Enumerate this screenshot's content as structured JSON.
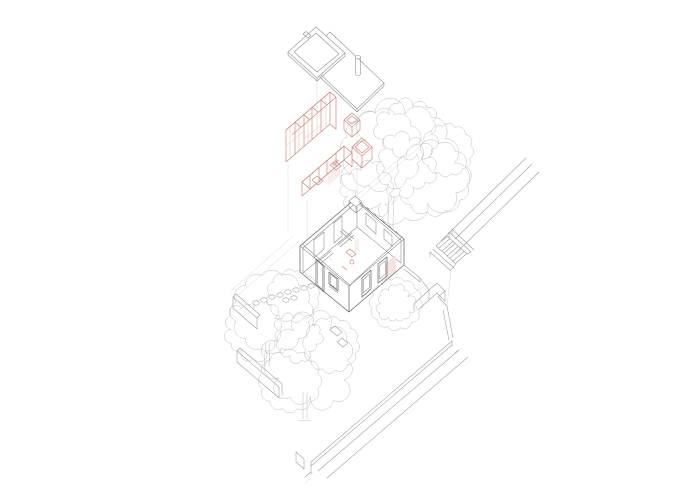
{
  "colors": {
    "background": "#ffffff",
    "site_linework": "#9a9a9a",
    "building_linework": "#5e5e5e",
    "light_linework": "#d6d6d6",
    "vegetation_linework": "#bdbdbd",
    "accent_orange": "#cf8170",
    "accent_orange_light": "#e9bdb1",
    "accent_orange_fill": "#f7e3dd"
  },
  "diagram": {
    "type": "exploded-axonometric-architecture-drawing",
    "text_labels": [],
    "exploded_layers": [
      {
        "name": "skylight-frame",
        "color": "gray"
      },
      {
        "name": "roof-slab",
        "color": "gray"
      },
      {
        "name": "flue-pipe",
        "color": "gray"
      },
      {
        "name": "furniture-layer",
        "color": "orange",
        "items": [
          "wardrobe-unit",
          "storage-box-small",
          "storage-box-large",
          "kitchen-island"
        ]
      },
      {
        "name": "house-shell",
        "color": "gray",
        "items": [
          "entry-door",
          "facade-windows",
          "interior-partitions",
          "interior-fixtures",
          "rooftop-chimney"
        ]
      }
    ],
    "site_elements": [
      {
        "name": "street-edge"
      },
      {
        "name": "exterior-staircase"
      },
      {
        "name": "retaining-walls"
      },
      {
        "name": "boundary-wall-west"
      },
      {
        "name": "boundary-wall-southwest"
      },
      {
        "name": "boundary-wall-southeast"
      },
      {
        "name": "stepping-stones"
      },
      {
        "name": "garden-pavers"
      },
      {
        "name": "large-tree"
      },
      {
        "name": "garden-tree-upper"
      },
      {
        "name": "garden-tree-lower"
      },
      {
        "name": "shrub"
      }
    ]
  }
}
